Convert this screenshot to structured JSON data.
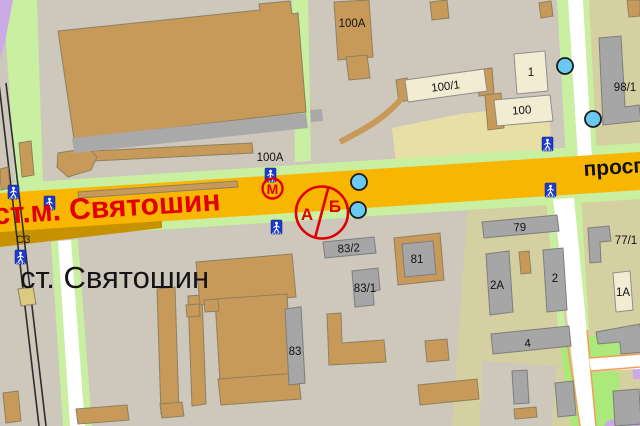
{
  "labels": {
    "avenue": "проспект",
    "metro_station": "ст.м. Святошин",
    "rail_station": "ст. Святошин",
    "compass": "СЗ",
    "metro_m": "М",
    "stop_a": "А",
    "stop_b": "Б"
  },
  "buildings": [
    "100А",
    "100А",
    "100/1",
    "1",
    "100",
    "98/1",
    "83/2",
    "81",
    "83/1",
    "83",
    "79",
    "2А",
    "2",
    "4",
    "77/1",
    "1А"
  ],
  "icons": {
    "metro": "metro-m-icon",
    "pedestrian_crossing": "pedestrian-crossing-icon",
    "transport_stop": "transport-stop-dot",
    "tram_section": "tram-section-a-b-icon"
  },
  "colors": {
    "background": "#cdc7bc",
    "background_olive": "#d5d0a2",
    "road_yellow": "#f8b600",
    "road_ramp_dark": "#c79200",
    "green_strip": "#c9efa0",
    "green_bright": "#abe97a",
    "purple_road": "#cbaae6",
    "building_tan": "#c89a59",
    "building_gray": "#a6a6a6",
    "building_cream": "#f2ecd3",
    "stop_blue": "#6ac9f3",
    "sign_blue": "#1d3ccf",
    "accent_red": "#e10000",
    "orange_casing": "#f0a050"
  }
}
